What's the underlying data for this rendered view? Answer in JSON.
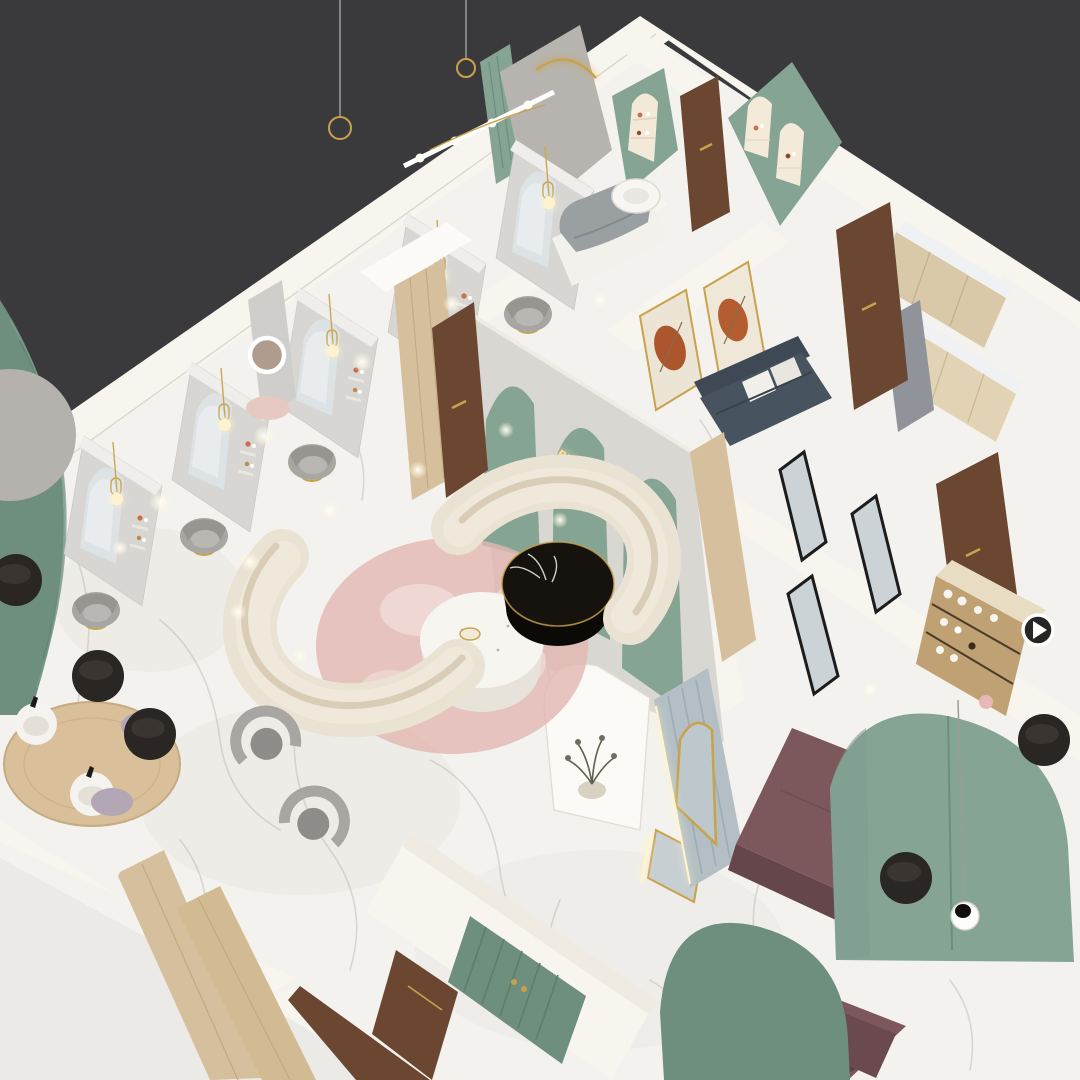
{
  "scene": {
    "description": "Isometric 3D rendering of a beauty salon and spa interior floor plan",
    "neon_sign": {
      "line1": "BYOUGLOW",
      "line2": "girl"
    }
  },
  "palette": {
    "bg": "#3a3a3c",
    "ground": "#eceae6",
    "floor": "#f4f2ee",
    "vein": "#b7b3ac",
    "wall": "#f8f5ef",
    "wallEdge": "#ddd6c9",
    "panel": "#d7d6d3",
    "mirror": "#dde2e4",
    "concrete": "#b7b4af",
    "sage": "#85a494",
    "sageDeep": "#6e8e7e",
    "cream": "#eae2d2",
    "gold": "#c9a24b",
    "neon": "#ffdda0",
    "wood": "#6b4732",
    "woodLight": "#d6bf9c",
    "plum": "#7c585c",
    "plumDark": "#65474b",
    "charcoal": "#2a2623",
    "navy": "#47535f",
    "chairGray": "#a8a6a2",
    "pink": "#e2b7b1",
    "lavender": "#b3a6b5",
    "steel": "#b3bfc4",
    "beige": "#d9c9a9"
  }
}
